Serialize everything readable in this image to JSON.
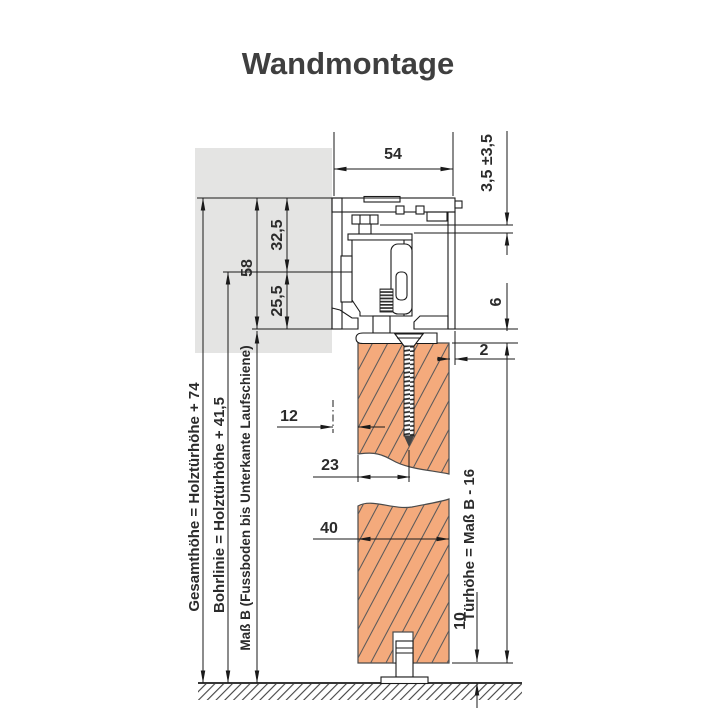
{
  "title": "Wandmontage",
  "colors": {
    "door_fill": "#f4aa7c",
    "wall_fill": "#e4e4e3",
    "line": "#1a1a1a",
    "text": "#2b2b2b"
  },
  "dims": {
    "track_depth": "54",
    "height_adjustment": "3,5 ±3,5",
    "profile_height": "58",
    "top_to_drill_line": "32,5",
    "drill_line_to_bottom": "25,5",
    "track_to_door_gap": "6",
    "door_to_track_edge": "2",
    "wall_to_door": "12",
    "door_face_to_screw": "23",
    "door_thickness": "40",
    "floor_to_door": "10"
  },
  "annotations": {
    "gesamthoehe": "Gesamthöhe = Holztürhöhe + 74",
    "bohrlinie": "Bohrlinie = Holztürhöhe + 41,5",
    "mass_b": "Maß B (Fussboden bis Unterkante Laufschiene)",
    "tuerhoehe": "Türhöhe = Maß B - 16"
  }
}
